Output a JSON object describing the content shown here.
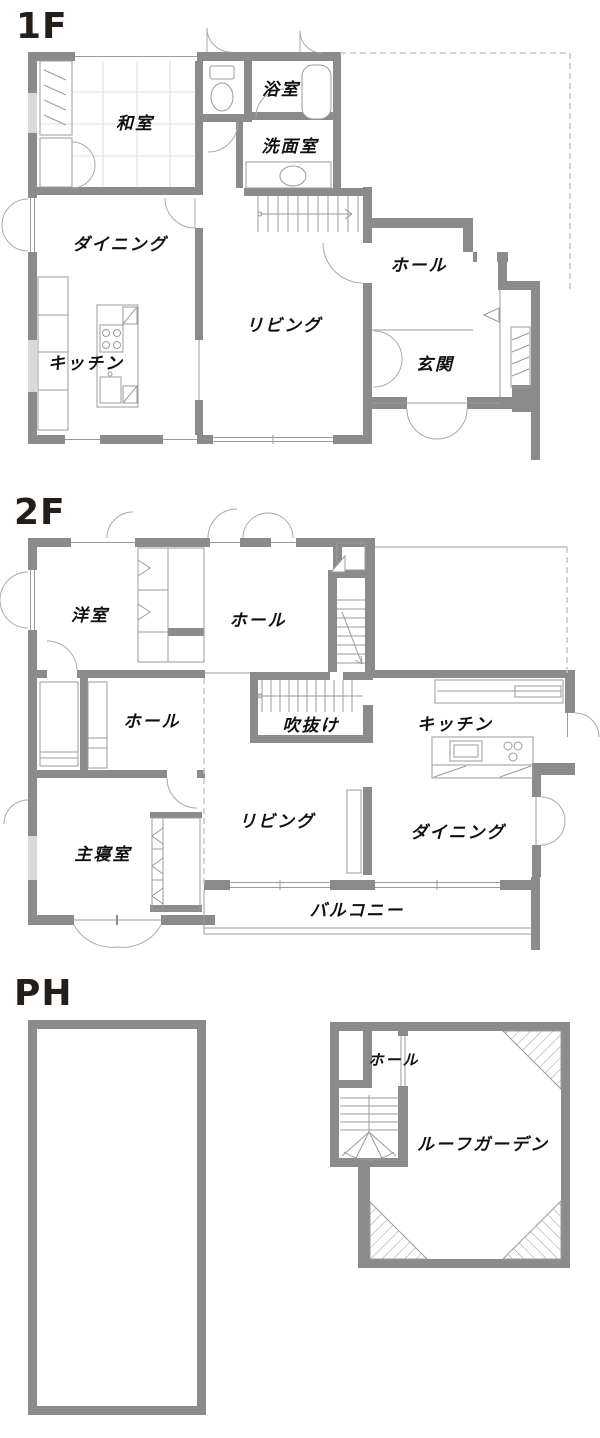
{
  "page": {
    "background": "#ffffff"
  },
  "colors": {
    "wall": "#8b8b8b",
    "fixture_line": "#9b9b9b",
    "door_arc": "#a9a9a9",
    "window_fill": "#d9d9d9",
    "tatami_line": "#dcdcdc",
    "dashed_line": "#c6c6c6",
    "label_text": "#111111",
    "title_text": "#251d18"
  },
  "floors": [
    {
      "title": "1F",
      "rooms": [
        {
          "name": "washitsu",
          "label": "和室"
        },
        {
          "name": "bathroom",
          "label": "浴室"
        },
        {
          "name": "washroom",
          "label": "洗面室"
        },
        {
          "name": "dining",
          "label": "ダイニング"
        },
        {
          "name": "living",
          "label": "リビング"
        },
        {
          "name": "hall",
          "label": "ホール"
        },
        {
          "name": "kitchen",
          "label": "キッチン"
        },
        {
          "name": "entrance",
          "label": "玄関"
        }
      ]
    },
    {
      "title": "2F",
      "rooms": [
        {
          "name": "youshitsu",
          "label": "洋室"
        },
        {
          "name": "hall-upper",
          "label": "ホール"
        },
        {
          "name": "hall-lower",
          "label": "ホール"
        },
        {
          "name": "void",
          "label": "吹抜け"
        },
        {
          "name": "kitchen",
          "label": "キッチン"
        },
        {
          "name": "living",
          "label": "リビング"
        },
        {
          "name": "dining",
          "label": "ダイニング"
        },
        {
          "name": "master-bedroom",
          "label": "主寝室"
        },
        {
          "name": "balcony",
          "label": "バルコニー"
        }
      ]
    },
    {
      "title": "PH",
      "rooms": [
        {
          "name": "hall",
          "label": "ホール"
        },
        {
          "name": "roof-garden",
          "label": "ルーフガーデン"
        }
      ]
    }
  ]
}
